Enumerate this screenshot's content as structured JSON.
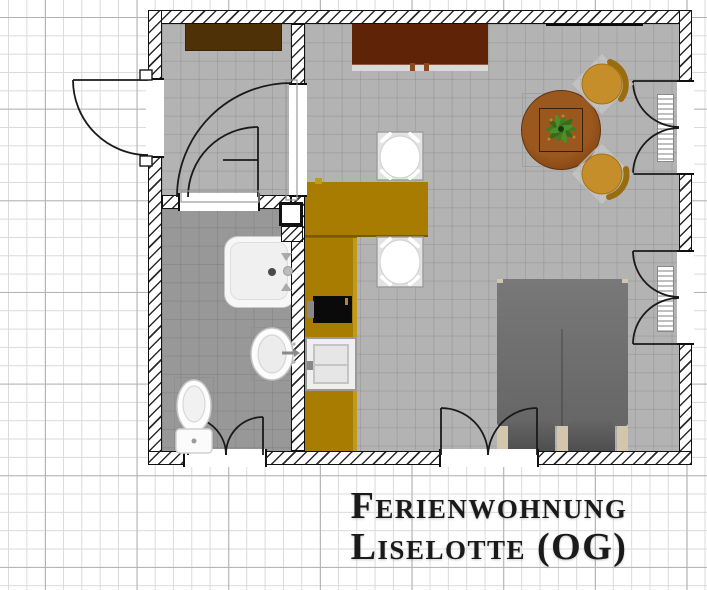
{
  "title": {
    "line1": "Ferienwohnung",
    "line2": "Liselotte (OG)"
  },
  "plan": {
    "items": [
      "entrance-hall",
      "bathroom",
      "living-room",
      "kitchen",
      "wardrobe",
      "sideboard",
      "wall-panel",
      "dining-table",
      "potted-plant",
      "wooden-chair",
      "wooden-chair",
      "bar-chair",
      "bar-chair",
      "breakfast-bar",
      "kitchen-counter",
      "stove",
      "kitchen-sink",
      "shower-tray",
      "washbasin",
      "toilet",
      "double-bed",
      "radiator",
      "radiator",
      "entrance-door",
      "interior-door",
      "bathroom-door",
      "casement-window",
      "casement-window",
      "bedroom-window"
    ]
  },
  "colors": {
    "grid_minor": "#dadada",
    "grid_major": "#b3b3b3",
    "wall_line": "#111111",
    "floor_light": "#b3b3b3",
    "floor_bath": "#989898",
    "counter_gold": "#a87c00",
    "wardrobe_brown": "#4f3108",
    "sideboard_maroon": "#5f2407",
    "table_brown": "#8a4815",
    "chair_wood": "#c68e2a",
    "chair_wood_dark": "#9a6c10",
    "bed_gray": "#6d6d6d",
    "bed_post": "#d3c6ac",
    "appliance_black": "#0a0a0a",
    "plant_green": "#3f7d22",
    "swing_line": "#1a1a1a",
    "text_black": "#1a1a1a"
  }
}
